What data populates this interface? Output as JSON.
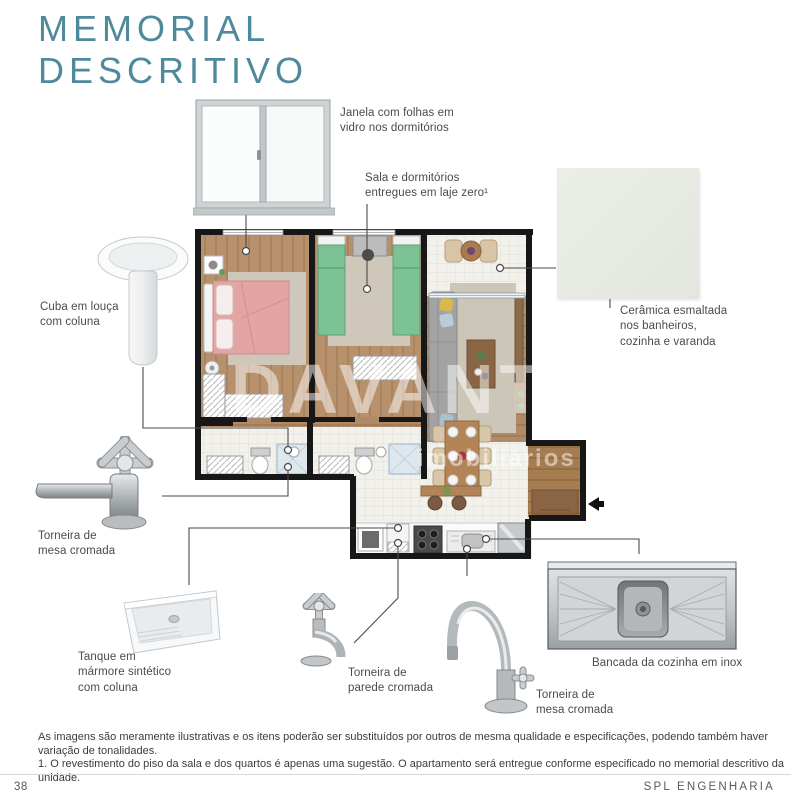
{
  "header": {
    "title": "MEMORIAL\nDESCRITIVO",
    "accent_color": "#4e8a9b"
  },
  "callouts": {
    "window": {
      "label": "Janela com folhas em\nvidro nos dormitórios"
    },
    "slab": {
      "label": "Sala e dormitórios\nentregues em laje zero¹"
    },
    "ceramic": {
      "label": "Cerâmica esmaltada\nnos banheiros,\ncozinha e varanda"
    },
    "basin": {
      "label": "Cuba em louça\ncom coluna"
    },
    "bath_faucet": {
      "label": "Torneira de\nmesa cromada"
    },
    "tank": {
      "label": "Tanque em\nmármore sintético\ncom coluna"
    },
    "wall_faucet": {
      "label": "Torneira de\nparede cromada"
    },
    "kitchen_faucet": {
      "label": "Torneira de\nmesa cromada"
    },
    "bench": {
      "label": "Bancada da cozinha em inox"
    }
  },
  "watermark": {
    "line1": "DAVANTI",
    "line2": "imobiliários"
  },
  "footer": {
    "disclaimer": "As imagens são meramente ilustrativas e os itens poderão ser substituídos por outros de mesma qualidade e especificações, podendo também haver variação de tonalidades.",
    "note": "1. O revestimento do piso da sala e dos quartos é apenas uma sugestão. O apartamento será entregue conforme especificado no memorial descritivo da unidade.",
    "page_number": "38",
    "brand": "SPL ENGENHARIA"
  }
}
